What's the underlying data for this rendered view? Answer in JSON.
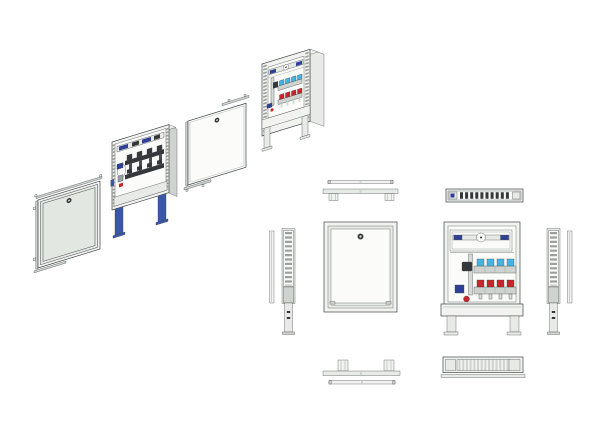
{
  "colors": {
    "background": "#ffffff",
    "line": "#3f4345",
    "line_soft": "#9aa09b",
    "metal_light": "#f2f3f1",
    "metal_mid": "#e7eae6",
    "metal_dark": "#cfd3cf",
    "panel_white": "#fbfcfa",
    "door_gray": "#e3e7e2",
    "pipe_gray": "#d6dad6",
    "flow_meter_cyan": "#45b4e3",
    "valve_red": "#c9262c",
    "fitting_blue": "#2e3f96",
    "leg_blue": "#3b57a7",
    "manifold_dark": "#35383b"
  },
  "drawing": {
    "kind": "manifold-cabinet-technical-drawing",
    "exploded_assembly": {
      "parts": [
        {
          "id": "door-frame-assembly",
          "features": [
            "outer-frame",
            "door-panel",
            "lock"
          ]
        },
        {
          "id": "cabinet-with-manifold",
          "features": [
            "slotted-side-rails",
            "top-rail-fittings",
            "manifold-valves",
            "blue-adjustable-legs"
          ]
        },
        {
          "id": "inner-cover-panel",
          "features": [
            "lock",
            "mounting-rails"
          ]
        },
        {
          "id": "open-cabinet-with-manifold",
          "features": [
            "slotted-side-rails",
            "top-rail-fittings",
            "flow-meters",
            "return-valves",
            "base-band",
            "legs"
          ]
        }
      ]
    },
    "orthographic_views": [
      {
        "id": "top-view-door-strip"
      },
      {
        "id": "top-view-cabinet-strip"
      },
      {
        "id": "top-view-manifold"
      },
      {
        "id": "front-view-closed"
      },
      {
        "id": "front-view-open"
      },
      {
        "id": "side-view-left"
      },
      {
        "id": "side-view-right"
      },
      {
        "id": "bottom-view-cabinet-strip"
      },
      {
        "id": "bottom-view-door-strip"
      },
      {
        "id": "bottom-view-slotted"
      }
    ],
    "manifold": {
      "loops": 4,
      "flow_meter_caps": 4,
      "return_valve_caps": 4
    }
  }
}
